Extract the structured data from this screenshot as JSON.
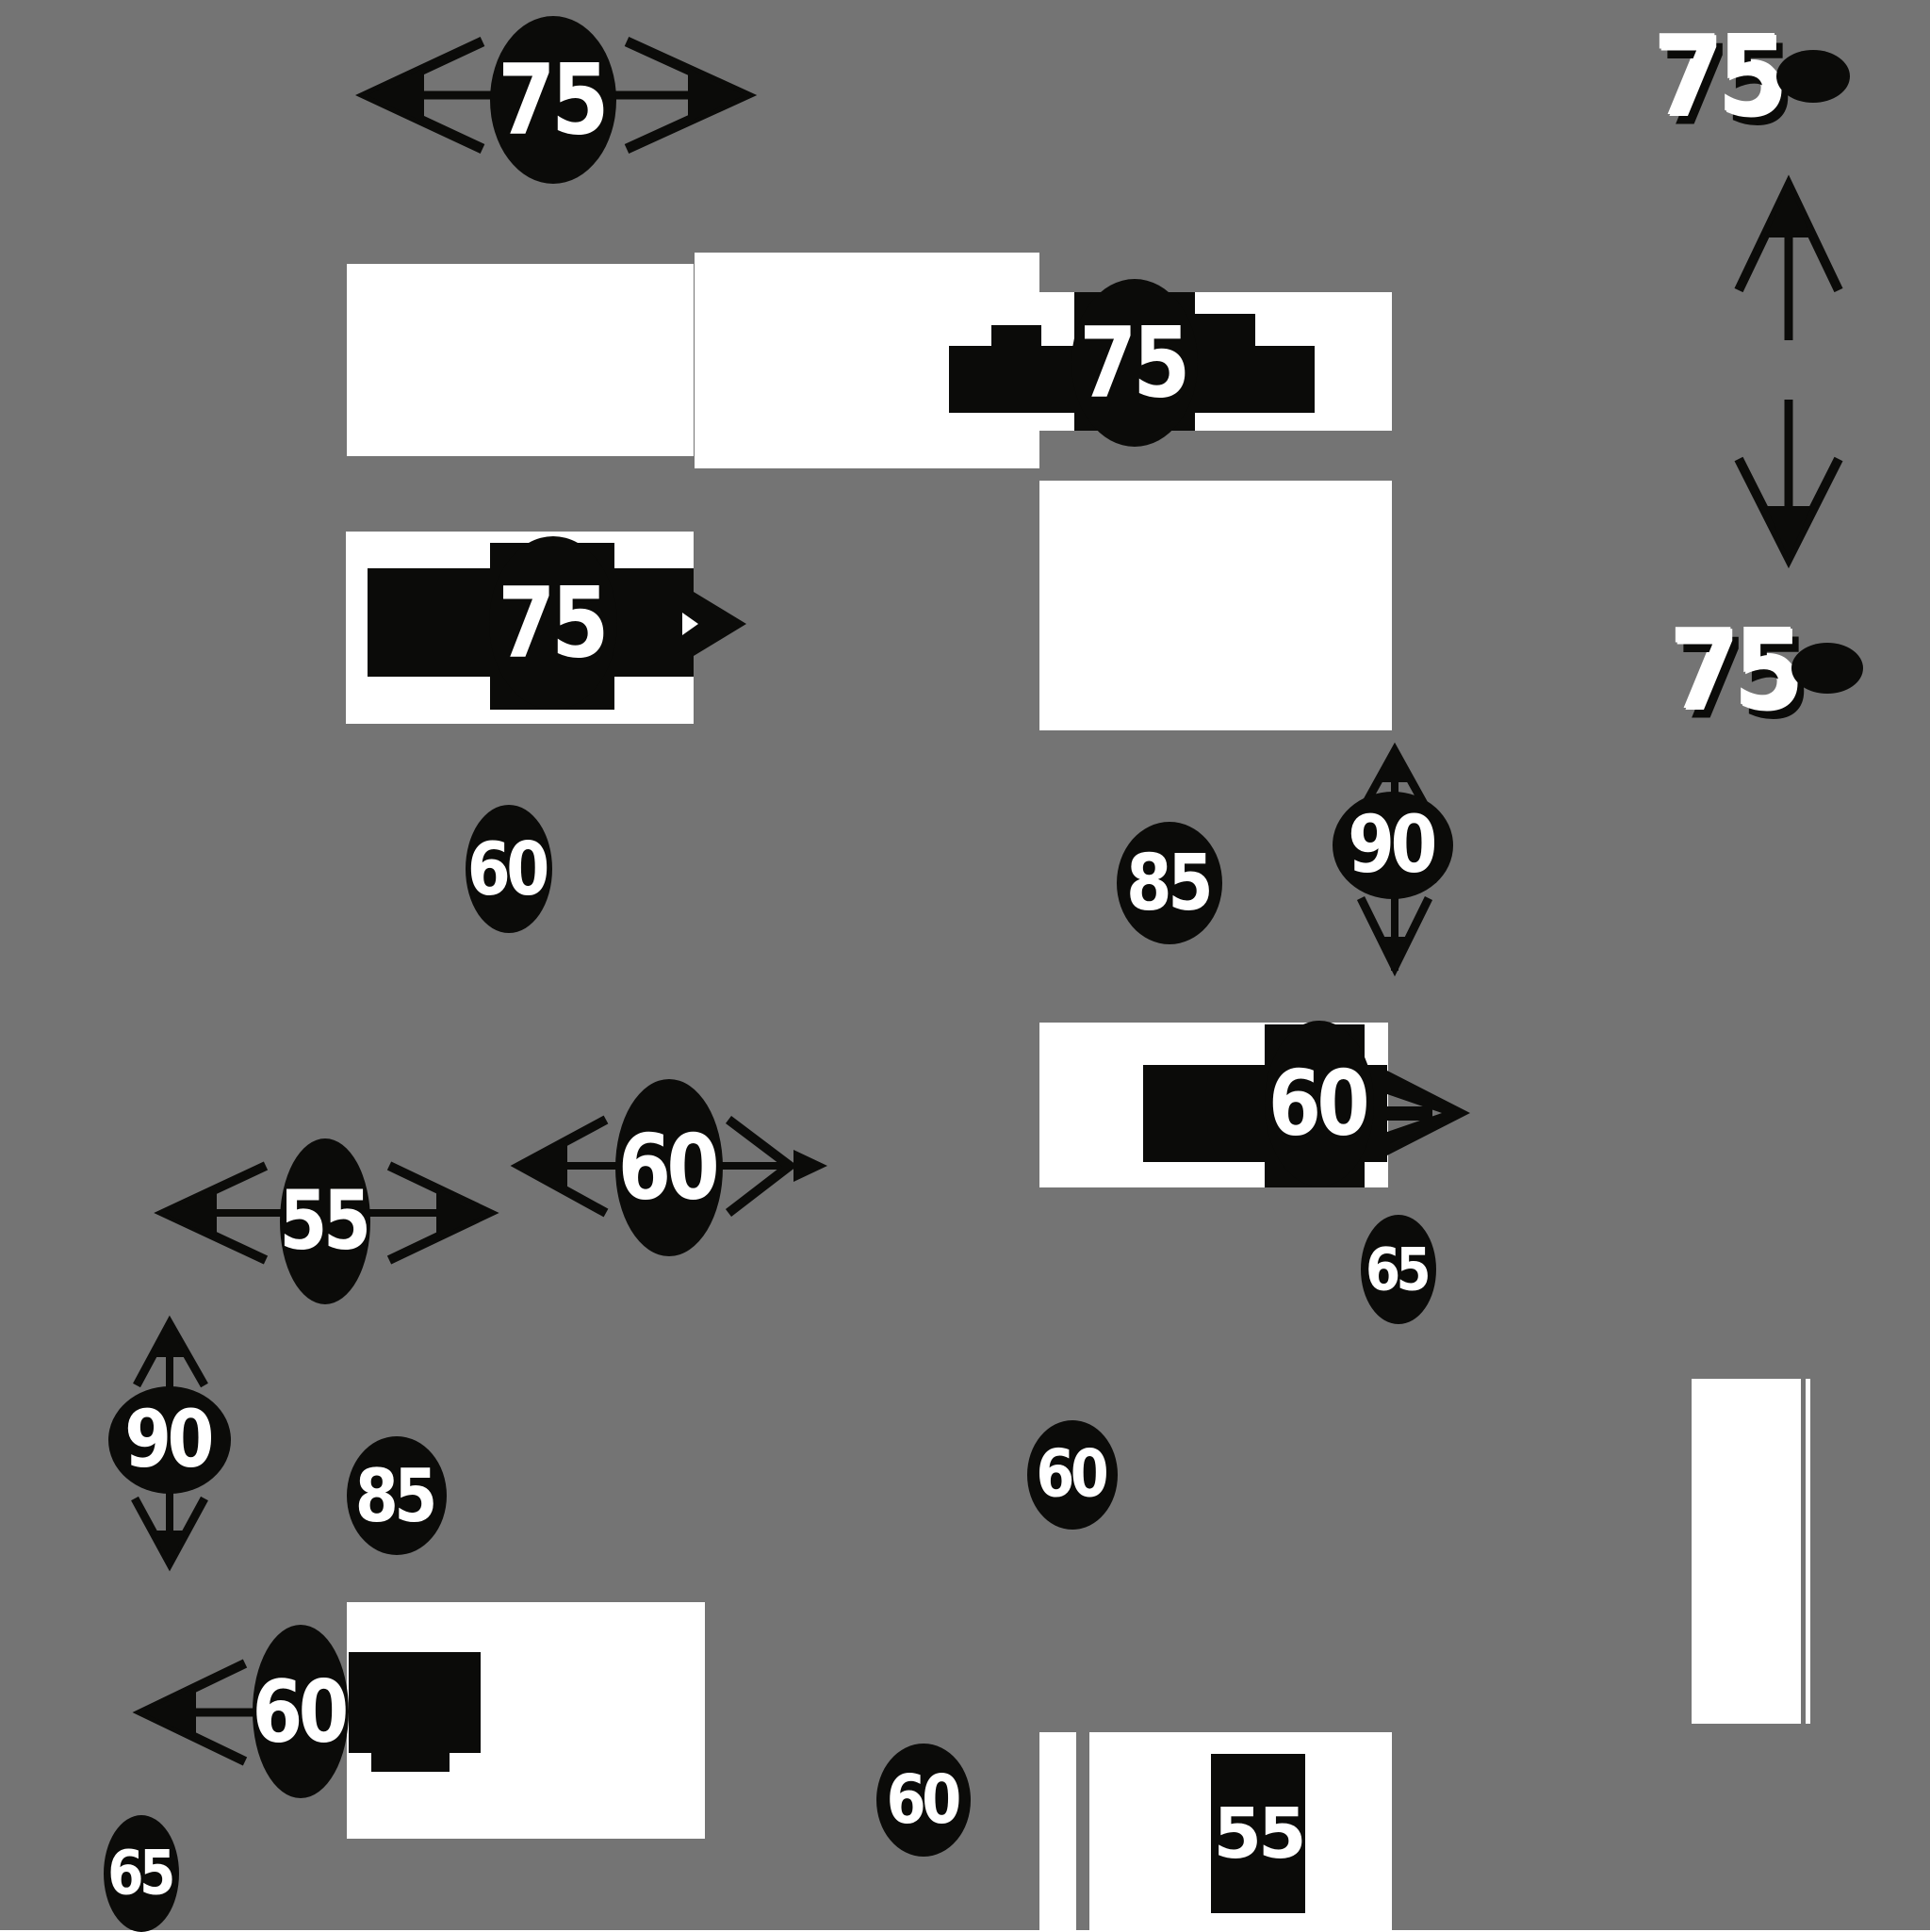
{
  "colors": {
    "background": "#747474",
    "ink": "#0b0b09",
    "paper": "#ffffff"
  },
  "labels": {
    "top_double_arrow_75": "75",
    "band_sign_75": "75",
    "row3_sign_75": "75",
    "corner_top_75": "75",
    "corner_bottom_75": "75",
    "oval_60_below_band": "60",
    "oval_85_right": "85",
    "oval_90_right": "90",
    "cluster_60_right": "60",
    "oval_65_right": "65",
    "double_arrow_55": "55",
    "double_arrow_60": "60",
    "oval_90_left": "90",
    "oval_85_left": "85",
    "oval_60_middle": "60",
    "cluster_60_left": "60",
    "oval_65_bottom_left": "65",
    "oval_60_bottom": "60",
    "rect_55_bottom": "55"
  }
}
